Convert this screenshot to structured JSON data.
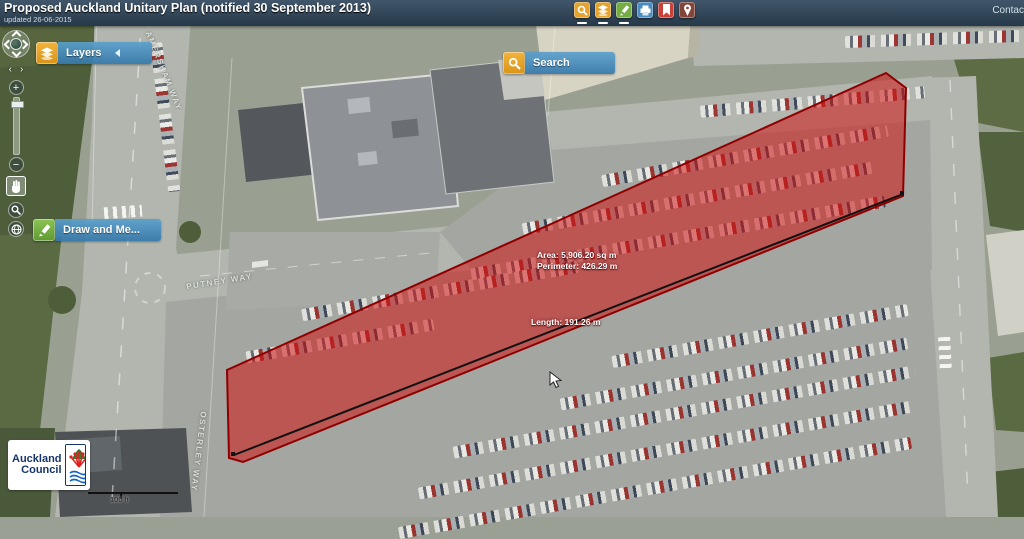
{
  "header": {
    "title": "Proposed Auckland Unitary Plan (notified 30 September 2013)",
    "updated": "updated 26-06-2015",
    "contact_link": "Contac",
    "toolbar": [
      {
        "name": "search-tool",
        "color": "#e3a32e",
        "active": true
      },
      {
        "name": "layers-tool",
        "color": "#e3a32e",
        "active": true
      },
      {
        "name": "draw-measure-tool",
        "color": "#74ae42",
        "active": true
      },
      {
        "name": "print-tool",
        "color": "#4a8cc0",
        "active": false
      },
      {
        "name": "bookmarks-tool",
        "color": "#c8423a",
        "active": false
      },
      {
        "name": "locate-tool",
        "color": "#83453a",
        "active": false
      }
    ]
  },
  "panels": {
    "layers_label": "Layers",
    "search_label": "Search",
    "draw_label": "Draw and Me..."
  },
  "measurement": {
    "area_label": "Area: 5,906.20 sq m",
    "perimeter_label": "Perimeter: 426.29 m",
    "length_label": "Length: 191.26 m",
    "fill_color": "#d01414",
    "fill_opacity": "0.55",
    "outline_color": "#8e0000",
    "line_color": "#111111"
  },
  "map": {
    "street_labels": [
      {
        "text": "PUTNEY WAY"
      },
      {
        "text": "OSTERLEY WAY"
      },
      {
        "text": "AMERSHAM WAY"
      }
    ],
    "scale_label": "100 ft"
  },
  "nav_control": [
    "pan",
    "rotate-left",
    "rotate-right",
    "zoom-in",
    "zoom-slider",
    "zoom-out",
    "pan-tool",
    "zoom-box",
    "full-extent"
  ],
  "logo": {
    "line1": "Auckland",
    "line2": "Council"
  }
}
